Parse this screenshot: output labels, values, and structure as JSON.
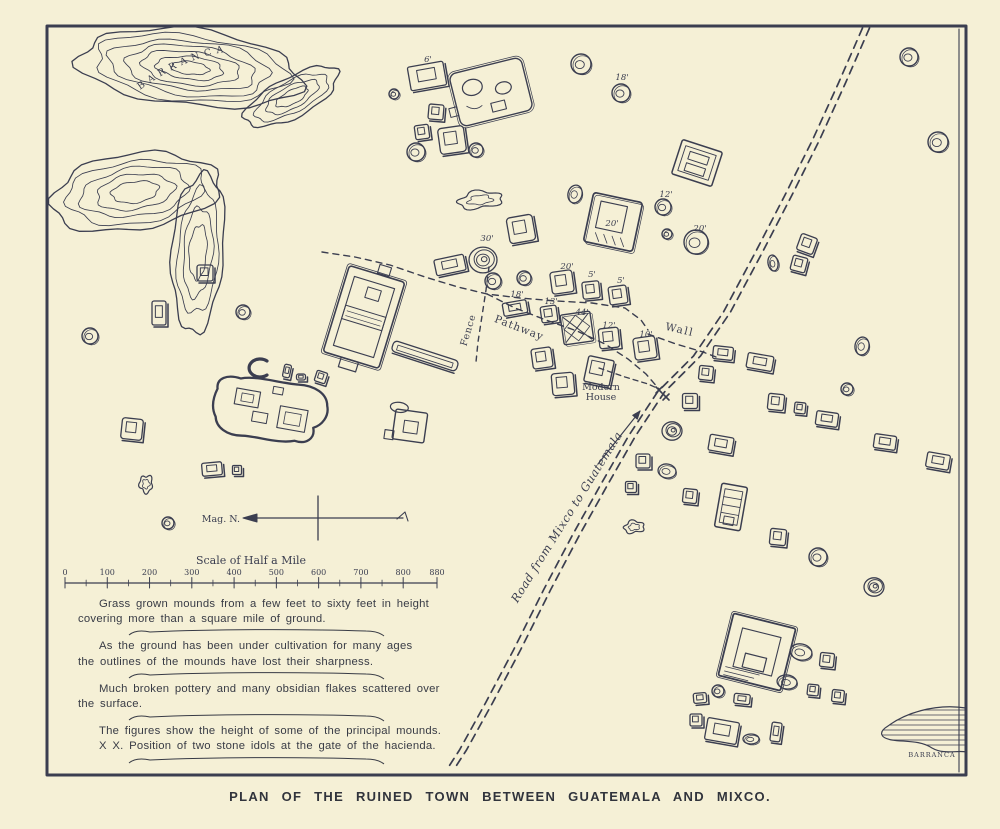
{
  "colors": {
    "paper": "#f5f0d6",
    "ink": "#3b3e50",
    "text_ink": "#383b45"
  },
  "caption": "PLAN OF THE RUINED TOWN BETWEEN GUATEMALA AND MIXCO.",
  "notes": [
    {
      "lines": [
        "Grass grown mounds from a few feet to sixty feet in height",
        "covering more than a square mile of ground."
      ],
      "flourish_after": true
    },
    {
      "lines": [
        "As the ground has been under cultivation for many ages",
        "the outlines of the mounds have lost their sharpness."
      ],
      "flourish_after": true
    },
    {
      "lines": [
        "Much broken pottery and many obsidian flakes scattered over",
        "the surface."
      ],
      "flourish_after": true
    },
    {
      "lines": [
        "The figures show the height of some of the principal mounds."
      ],
      "flourish_after": false
    },
    {
      "lines": [
        "X X. Position of two stone idols at the gate of the hacienda."
      ],
      "flourish_after": true
    }
  ],
  "scale_bar": {
    "title": "Scale of Half a Mile",
    "x0": 65,
    "x1": 437,
    "y": 583,
    "title_x": 251,
    "title_y": 564,
    "tick_values": [
      "0",
      "100",
      "200",
      "300",
      "400",
      "500",
      "600",
      "700",
      "800",
      "880"
    ],
    "max": 880
  },
  "compass": {
    "label": "Mag. N.",
    "label_x": 240,
    "label_y": 522,
    "x0": 246,
    "x1": 403,
    "y": 518,
    "cross_x": 318,
    "cross_y0": 496,
    "cross_y1": 540
  },
  "map_labels": [
    {
      "text": "Road from Mixco to Guatemala",
      "x": 570,
      "y": 519,
      "rot": -58,
      "size": 11.5,
      "italic": true,
      "spacing": 0.6
    },
    {
      "text": "Fence",
      "x": 471,
      "y": 331,
      "rot": -73,
      "size": 9.5,
      "spacing": 0.8
    },
    {
      "text": "Pathway",
      "x": 518,
      "y": 331,
      "rot": 21,
      "size": 10.5,
      "spacing": 1
    },
    {
      "text": "Wall",
      "x": 679,
      "y": 333,
      "rot": 13,
      "size": 10.5,
      "spacing": 1.5
    },
    {
      "text": "Modern",
      "x": 601,
      "y": 390,
      "rot": 0,
      "size": 9.5
    },
    {
      "text": "House",
      "x": 601,
      "y": 400,
      "rot": 0,
      "size": 9.5
    }
  ],
  "barranca_top": {
    "label": "BARRANCA",
    "label_path": "M 140,90 Q 200,46 262,50",
    "blobs": [
      {
        "cx": 190,
        "cy": 68,
        "rx": 112,
        "ry": 38,
        "rot": 6,
        "scales": [
          1,
          0.86,
          0.72,
          0.58,
          0.44,
          0.3,
          0.17
        ]
      },
      {
        "cx": 292,
        "cy": 97,
        "rx": 52,
        "ry": 20,
        "rot": -28,
        "scales": [
          1,
          0.78,
          0.56,
          0.34
        ]
      },
      {
        "cx": 135,
        "cy": 192,
        "rx": 85,
        "ry": 38,
        "rot": -8,
        "scales": [
          1,
          0.82,
          0.64,
          0.46,
          0.28
        ]
      },
      {
        "cx": 198,
        "cy": 252,
        "rx": 26,
        "ry": 80,
        "rot": 4,
        "scales": [
          1,
          0.78,
          0.56,
          0.34
        ]
      }
    ]
  },
  "barranca_bottom": {
    "label": "BARRANCA",
    "label_x": 932,
    "label_y": 757,
    "outline": "M 966,708 C 934,703 904,714 888,726 C 878,732 880,738 892,740 C 904,742 920,740 932,748 C 944,755 958,750 966,752 Z"
  },
  "dashed_paths": [
    {
      "name": "road",
      "double": true,
      "width": 1.7,
      "dash": "8 6",
      "pts": [
        [
          866,
          28
        ],
        [
          842,
          83
        ],
        [
          816,
          140
        ],
        [
          788,
          196
        ],
        [
          758,
          254
        ],
        [
          727,
          312
        ],
        [
          697,
          356
        ],
        [
          661,
          392
        ],
        [
          632,
          436
        ],
        [
          604,
          485
        ],
        [
          576,
          535
        ],
        [
          547,
          590
        ],
        [
          517,
          650
        ],
        [
          489,
          703
        ],
        [
          463,
          750
        ],
        [
          452,
          767
        ]
      ]
    },
    {
      "name": "pathway-upper",
      "width": 1.4,
      "dash": "6 5",
      "pts": [
        [
          322,
          252
        ],
        [
          355,
          257
        ],
        [
          390,
          265
        ],
        [
          425,
          277
        ],
        [
          458,
          287
        ],
        [
          487,
          294
        ],
        [
          520,
          298
        ],
        [
          556,
          301
        ],
        [
          592,
          303
        ],
        [
          625,
          308
        ],
        [
          641,
          320
        ],
        [
          648,
          330
        ]
      ]
    },
    {
      "name": "wall-line",
      "width": 1.4,
      "dash": "6 5",
      "pts": [
        [
          648,
          334
        ],
        [
          676,
          344
        ],
        [
          703,
          352
        ],
        [
          716,
          357
        ]
      ]
    },
    {
      "name": "fence-line",
      "width": 1.4,
      "dash": "5 5",
      "pts": [
        [
          489,
          267
        ],
        [
          486,
          290
        ],
        [
          482,
          316
        ],
        [
          478,
          342
        ],
        [
          476,
          362
        ]
      ]
    },
    {
      "name": "pathway-line",
      "width": 1.4,
      "dash": "6 5",
      "pts": [
        [
          487,
          294
        ],
        [
          515,
          308
        ],
        [
          546,
          320
        ],
        [
          577,
          331
        ],
        [
          605,
          344
        ],
        [
          628,
          359
        ],
        [
          646,
          374
        ],
        [
          659,
          389
        ]
      ]
    },
    {
      "name": "house-connector",
      "width": 1.3,
      "dash": "5 4",
      "pts": [
        [
          599,
          368
        ],
        [
          625,
          377
        ],
        [
          648,
          384
        ],
        [
          659,
          389
        ]
      ]
    }
  ],
  "road_arrow": {
    "from": [
      598,
      464
    ],
    "to": [
      640,
      411
    ]
  },
  "idol_marks": [
    [
      659,
      390
    ],
    [
      666,
      397
    ]
  ],
  "mounds": [
    {
      "kind": "rect",
      "x": 427,
      "y": 76,
      "w": 36,
      "h": 24,
      "rot": -10,
      "label": "6'",
      "lx": 428,
      "ly": 62
    },
    {
      "kind": "platform",
      "x": 491,
      "y": 92,
      "rot": -14
    },
    {
      "kind": "round",
      "x": 581,
      "y": 64,
      "r": 10
    },
    {
      "kind": "round",
      "x": 621,
      "y": 93,
      "r": 9,
      "label": "18'",
      "lx": 622,
      "ly": 80
    },
    {
      "kind": "sq",
      "x": 436,
      "y": 112,
      "w": 15,
      "rot": 5
    },
    {
      "kind": "sq",
      "x": 422,
      "y": 132,
      "w": 14,
      "rot": -8
    },
    {
      "kind": "round",
      "x": 416,
      "y": 152,
      "r": 9
    },
    {
      "kind": "sq",
      "x": 452,
      "y": 140,
      "w": 26,
      "rot": -8
    },
    {
      "kind": "round",
      "x": 476,
      "y": 150,
      "r": 7
    },
    {
      "kind": "round",
      "x": 394,
      "y": 94,
      "r": 5
    },
    {
      "kind": "round",
      "x": 909,
      "y": 57,
      "r": 9
    },
    {
      "kind": "round",
      "x": 938,
      "y": 142,
      "r": 10
    },
    {
      "kind": "blob",
      "x": 480,
      "y": 200,
      "w": 44,
      "h": 17,
      "rot": -6
    },
    {
      "kind": "oval",
      "x": 575,
      "y": 194,
      "rx": 7,
      "ry": 9,
      "rot": 15
    },
    {
      "kind": "bigsq",
      "x": 613,
      "y": 222,
      "w": 50,
      "rot": 12,
      "label": "20'",
      "lx": 612,
      "ly": 226
    },
    {
      "kind": "round",
      "x": 663,
      "y": 207,
      "r": 8,
      "label": "12'",
      "lx": 666,
      "ly": 197
    },
    {
      "kind": "round",
      "x": 667,
      "y": 234,
      "r": 5
    },
    {
      "kind": "round",
      "x": 696,
      "y": 242,
      "r": 12,
      "label": "20'",
      "lx": 700,
      "ly": 231
    },
    {
      "kind": "sq",
      "x": 521,
      "y": 229,
      "w": 26,
      "rot": -10
    },
    {
      "kind": "ring",
      "x": 483,
      "y": 260,
      "r": 14,
      "label": "30'",
      "lx": 487,
      "ly": 241
    },
    {
      "kind": "rect",
      "x": 450,
      "y": 265,
      "w": 30,
      "h": 16,
      "rot": -12
    },
    {
      "kind": "round",
      "x": 493,
      "y": 281,
      "r": 8
    },
    {
      "kind": "round",
      "x": 524,
      "y": 278,
      "r": 7
    },
    {
      "kind": "sq",
      "x": 562,
      "y": 282,
      "w": 22,
      "rot": -8,
      "label": "20'",
      "lx": 567,
      "ly": 269
    },
    {
      "kind": "sq",
      "x": 591,
      "y": 290,
      "w": 17,
      "rot": -6,
      "label": "5'",
      "lx": 592,
      "ly": 277
    },
    {
      "kind": "sq",
      "x": 618,
      "y": 295,
      "w": 18,
      "rot": -8,
      "label": "5'",
      "lx": 621,
      "ly": 283
    },
    {
      "kind": "rect",
      "x": 515,
      "y": 308,
      "w": 24,
      "h": 13,
      "rot": -10,
      "label": "18'",
      "lx": 517,
      "ly": 297
    },
    {
      "kind": "sq",
      "x": 549,
      "y": 314,
      "w": 16,
      "rot": -8,
      "label": "13'",
      "lx": 551,
      "ly": 304
    },
    {
      "kind": "bigx",
      "x": 577,
      "y": 328,
      "w": 30,
      "rot": -8,
      "label": "44'",
      "lx": 582,
      "ly": 315
    },
    {
      "kind": "sq",
      "x": 609,
      "y": 338,
      "w": 20,
      "rot": -6,
      "label": "12'",
      "lx": 609,
      "ly": 328
    },
    {
      "kind": "sq",
      "x": 645,
      "y": 348,
      "w": 22,
      "rot": -8,
      "label": "10'",
      "lx": 646,
      "ly": 337
    },
    {
      "kind": "sq",
      "x": 542,
      "y": 358,
      "w": 20,
      "rot": -8
    },
    {
      "kind": "sq",
      "x": 563,
      "y": 384,
      "w": 22,
      "rot": -5
    },
    {
      "kind": "house",
      "x": 599,
      "y": 371,
      "w": 26,
      "rot": 12
    },
    {
      "kind": "tworoom",
      "x": 697,
      "y": 163,
      "rot": 18
    },
    {
      "kind": "sq",
      "x": 807,
      "y": 244,
      "w": 17,
      "rot": 20
    },
    {
      "kind": "sq",
      "x": 799,
      "y": 264,
      "w": 15,
      "rot": 15
    },
    {
      "kind": "oval",
      "x": 773,
      "y": 263,
      "rx": 5,
      "ry": 8,
      "rot": -10
    },
    {
      "kind": "rect",
      "x": 723,
      "y": 353,
      "w": 20,
      "h": 13,
      "rot": 6
    },
    {
      "kind": "sq",
      "x": 706,
      "y": 373,
      "w": 14,
      "rot": 6
    },
    {
      "kind": "rect",
      "x": 760,
      "y": 362,
      "w": 26,
      "h": 15,
      "rot": 10
    },
    {
      "kind": "sq",
      "x": 690,
      "y": 401,
      "w": 15,
      "rot": 0
    },
    {
      "kind": "sq",
      "x": 776,
      "y": 402,
      "w": 16,
      "rot": 6
    },
    {
      "kind": "sq",
      "x": 800,
      "y": 408,
      "w": 11,
      "rot": 6
    },
    {
      "kind": "rect",
      "x": 827,
      "y": 419,
      "w": 22,
      "h": 14,
      "rot": 8
    },
    {
      "kind": "rect",
      "x": 885,
      "y": 442,
      "w": 22,
      "h": 14,
      "rot": 8
    },
    {
      "kind": "rect",
      "x": 938,
      "y": 461,
      "w": 23,
      "h": 15,
      "rot": 10
    },
    {
      "kind": "oval",
      "x": 862,
      "y": 346,
      "rx": 7,
      "ry": 9,
      "rot": 10
    },
    {
      "kind": "round",
      "x": 847,
      "y": 389,
      "r": 6
    },
    {
      "kind": "ring",
      "x": 672,
      "y": 431,
      "r": 10
    },
    {
      "kind": "sq",
      "x": 643,
      "y": 461,
      "w": 14,
      "rot": 0
    },
    {
      "kind": "oval",
      "x": 667,
      "y": 471,
      "rx": 9,
      "ry": 7,
      "rot": 10
    },
    {
      "kind": "rect",
      "x": 721,
      "y": 444,
      "w": 24,
      "h": 16,
      "rot": 10
    },
    {
      "kind": "sq",
      "x": 631,
      "y": 487,
      "w": 11,
      "rot": 0
    },
    {
      "kind": "sq",
      "x": 690,
      "y": 496,
      "w": 14,
      "rot": 6
    },
    {
      "kind": "tall",
      "x": 731,
      "y": 507,
      "rot": 10
    },
    {
      "kind": "blob",
      "x": 634,
      "y": 527,
      "w": 20,
      "h": 12,
      "rot": -5
    },
    {
      "kind": "sq",
      "x": 778,
      "y": 537,
      "w": 16,
      "rot": 6
    },
    {
      "kind": "round",
      "x": 818,
      "y": 557,
      "r": 9
    },
    {
      "kind": "ring",
      "x": 874,
      "y": 587,
      "r": 10
    },
    {
      "kind": "pyramid",
      "x": 757,
      "y": 652,
      "w": 64,
      "rot": 14
    },
    {
      "kind": "oval",
      "x": 801,
      "y": 652,
      "rx": 11,
      "ry": 8,
      "rot": 12
    },
    {
      "kind": "sq",
      "x": 827,
      "y": 660,
      "w": 14,
      "rot": 6
    },
    {
      "kind": "oval",
      "x": 787,
      "y": 682,
      "rx": 10,
      "ry": 7,
      "rot": 8
    },
    {
      "kind": "sq",
      "x": 813,
      "y": 690,
      "w": 11,
      "rot": 6
    },
    {
      "kind": "sq",
      "x": 838,
      "y": 696,
      "w": 12,
      "rot": 6
    },
    {
      "kind": "rect",
      "x": 700,
      "y": 698,
      "w": 13,
      "h": 10,
      "rot": -5
    },
    {
      "kind": "round",
      "x": 718,
      "y": 691,
      "r": 6
    },
    {
      "kind": "rect",
      "x": 742,
      "y": 699,
      "w": 16,
      "h": 10,
      "rot": 6
    },
    {
      "kind": "sq",
      "x": 696,
      "y": 720,
      "w": 12,
      "rot": 0
    },
    {
      "kind": "rect",
      "x": 722,
      "y": 731,
      "w": 32,
      "h": 22,
      "rot": 10
    },
    {
      "kind": "oval",
      "x": 751,
      "y": 739,
      "rx": 8,
      "ry": 5,
      "rot": 0
    },
    {
      "kind": "rect",
      "x": 776,
      "y": 732,
      "w": 10,
      "h": 19,
      "rot": 8
    },
    {
      "kind": "round",
      "x": 90,
      "y": 336,
      "r": 8
    },
    {
      "kind": "rect",
      "x": 159,
      "y": 313,
      "w": 14,
      "h": 24,
      "rot": 0
    },
    {
      "kind": "round",
      "x": 243,
      "y": 312,
      "r": 7
    },
    {
      "kind": "sq",
      "x": 205,
      "y": 273,
      "w": 16,
      "rot": 0
    },
    {
      "kind": "sq",
      "x": 132,
      "y": 429,
      "w": 21,
      "rot": 6
    },
    {
      "kind": "blob",
      "x": 146,
      "y": 484,
      "w": 13,
      "h": 17,
      "rot": 0
    },
    {
      "kind": "round",
      "x": 168,
      "y": 523,
      "r": 6
    },
    {
      "kind": "rect",
      "x": 212,
      "y": 469,
      "w": 20,
      "h": 13,
      "rot": -5
    },
    {
      "kind": "sq",
      "x": 237,
      "y": 470,
      "w": 9,
      "rot": 0
    },
    {
      "kind": "ballcourt",
      "x": 364,
      "y": 317,
      "rot": 17
    },
    {
      "kind": "longmound",
      "x": 425,
      "y": 356,
      "rot": 18
    },
    {
      "kind": "enclosure",
      "x": 270,
      "y": 408,
      "rot": 10
    },
    {
      "kind": "cshape",
      "x": 258,
      "y": 368,
      "rot": 0
    },
    {
      "kind": "rect",
      "x": 287,
      "y": 371,
      "w": 7,
      "h": 13,
      "rot": 12
    },
    {
      "kind": "rect",
      "x": 301,
      "y": 377,
      "w": 9,
      "h": 6,
      "rot": 0
    },
    {
      "kind": "sq",
      "x": 321,
      "y": 377,
      "w": 11,
      "rot": 18
    },
    {
      "kind": "annex",
      "x": 410,
      "y": 425,
      "rot": 8
    }
  ]
}
